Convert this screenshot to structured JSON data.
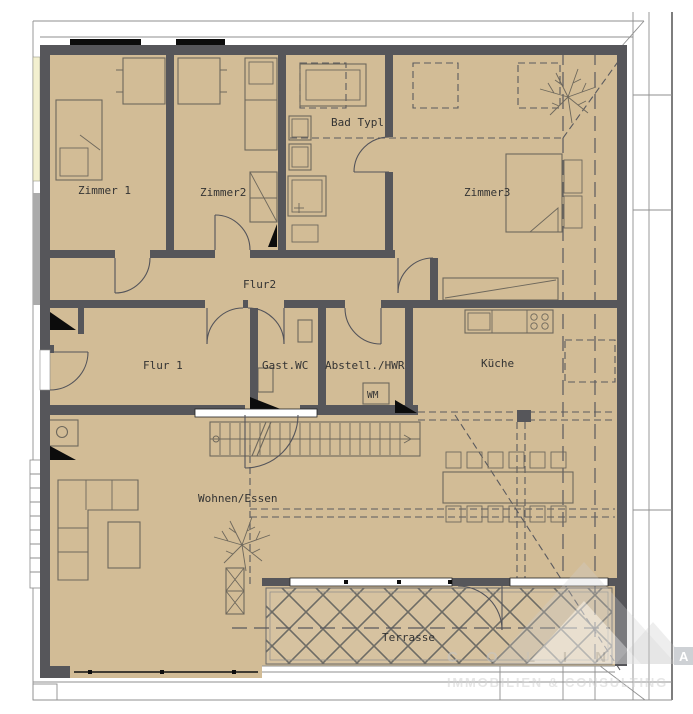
{
  "rooms": {
    "zimmer1": "Zimmer 1",
    "zimmer2": "Zimmer2",
    "bad": "Bad Typl",
    "zimmer3": "Zimmer3",
    "flur2": "Flur2",
    "flur1": "Flur 1",
    "gast_wc": "Gast.WC",
    "abstell": "Abstell./HWR",
    "kueche": "Küche",
    "wohnen": "Wohnen/Essen",
    "terrasse": "Terrasse"
  },
  "fixtures": {
    "washing_machine": "WM"
  },
  "watermark": {
    "letters": "C O L I N",
    "boxed_letter": "A",
    "tagline": "IMMOBILIEN & CONSULTING"
  },
  "colors": {
    "floor": "#d2bc96",
    "wall": "#56565a",
    "window_glass": "#f3f0d0",
    "lattice": "#62625e"
  }
}
